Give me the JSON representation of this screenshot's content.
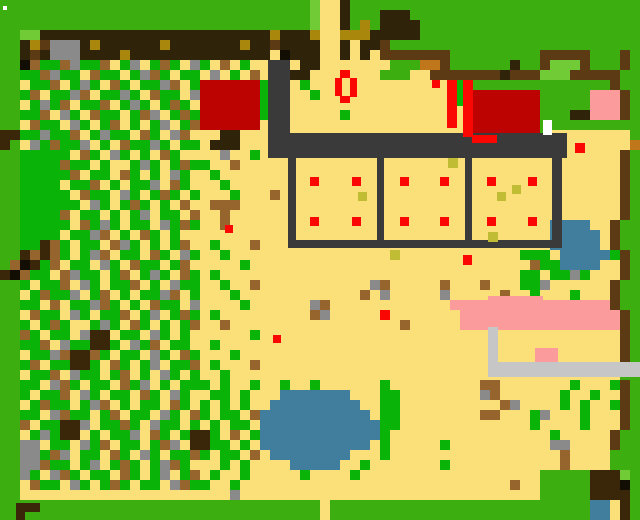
{
  "map": {
    "kind": "pixel-tile-world-map",
    "cols": 64,
    "rows": 52,
    "tile_size": 10,
    "palette": {
      "G": "#3CAE10",
      "V": "#0AB307",
      "L": "#70CB36",
      "Y": "#FBDF79",
      "B": "#2F2409",
      "F": "#5C3A13",
      "b": "#95652D",
      "N": "#3A2709",
      "O": "#C0771C",
      "A": "#A9860C",
      "k": "#C0BD35",
      "K": "#3A3A3A",
      "S": "#8A8A8A",
      "s": "#C6C6C6",
      "R": "#BC0302",
      "r": "#FB0703",
      "P": "#FB9B9B",
      "W": "#417E9E",
      "w": "#FFFFFF",
      "E": "#120E04"
    },
    "palette_legend": {
      "G": "grass-border-green",
      "V": "vegetation-green",
      "L": "light-green",
      "Y": "sand-yellow",
      "B": "dark-band-brown",
      "F": "fence-brown",
      "b": "dirt-brown",
      "N": "dark-blob-brown",
      "O": "copper-orange",
      "A": "gold-accent",
      "k": "khaki-sprout",
      "K": "compound-dark-gray",
      "S": "stone-gray",
      "s": "road-light-gray",
      "R": "building-dark-red",
      "r": "bright-red",
      "P": "pink",
      "W": "water-blue",
      "w": "white",
      "E": "near-black"
    },
    "grid": [
      "GGGGGGGGGGGGGGGGGGGGGGGGGGGGGGGLYYBGGGGGGGGGGGGGGGGGGGGGGGGGGGG",
      "GGGGGGGGGGGGGGGGGGGGGGGGGGGGGGGLYYBGGGBBBGGGGGGGGGGGGGGGGGGGGGG",
      "GGGGGGGGGGGGGGGGGGGGGGGGGGGGGGGLYYBGAGBBBBGGGGGGGGGGGGGGGGGGGGG",
      "GGLLBBBBBBBBBBBBBBBBBBBBBBBABBBAYYAAABBBBBGGGGGGGGGGGGGGGGGGGGGG",
      "GGBAFSSSBABBBBBBABBBBBBBABBFBBBBYYBYBBFGGGGGGGGGGGGGGGGGGGGGGGGG",
      "GGBFBSSSBBBBABBBBBBBBBBBBBBYEBBBYYBYBYFFFFFFFGGGGGGGGGFFFFFGGGFG",
      "GGEbVVbSVVbYVSYVbVYSVYbYVYYYYYBBYYYYYYYGGGOOFGGGGGGBGGFLLLFGGGFG",
      "GGVVbSVVYbVVYVSbVYVVYSYVYbYYYBBYYYYYYYGGGYYFFFFFFFBFFFLLLFFFFFG",
      "GGYVVbYVSVYbVYVVSbYVRRRRRRVYYYVYYYYYYYYYYYYYYYGGGGGGGGGGGGGGGFG",
      "GGVbYVVSbYVVSVYbVVYSRRRRRRVYYYYVYYYYYYYYYYYYYYYRRRRRRRGGGGGPPPFG",
      "GGYVSVbYVVbYVSVYVbVYRRRRRRVYYYYYYYYYYYYYYYYYYYYRRRRRRRGGGGGPPPFG",
      "GGVVbYSVYbVVYVbSYVbVRRRRRRVYYYYYYYVYYYYYYYYYYYYRRRRRRRGGGBBPPPFG",
      "GGYbVVYSVYVbYVYVSYVbRRRRRRYYYYYYYYYYYYYYYYYYYYYRRRRRRRGGGGGGGGGG",
      "NNVVSVVbYVSVVYbVYSbYYYBBYYYYYYYYYYYYYYYYYYYYYYYRRRRRRRGYYYYYYYYG",
      "NGYSVbVVSYVYbVVSVYVVYBBBYYYYYYYYYYYYYYYYYYYYYYYYYYYYYYYYYYYYYYYO",
      "GGVVVVVYbVYSVYVYbVYYYYSYYVYYYYYYYYYYYYYYYYYYYYYYYYYYYYYYYYYYYYFG",
      "GGVVVVbVVYVYYVSVYVbVVYYbYYYYYYYYYYYYYYYYYYYYYYYYYYYYYYYYYYYYYYFG",
      "GGVVVVVbYVVYbVYVYSVYYVYYYYYYYYYYYYYYYYYYYYYYYYYYYYYYYYYYYYYYYYFG",
      "GGVVVVYVVbYVYVVSYbVYYYVYYYYYYYYYYYYYYYYYYYYYYYYYYYYYYYYYYYYYYYFG",
      "GGVVVVVYbVVYSVYVbVYVYYYVYYYbYYYYYYYYYYYYYYYYYYYYYYYYYYYYYYYYYYFG",
      "GGVVVVVVYSVYVbVYVYbYYbbbYYYYYYYYYYYYYYYYYYYYYYYYYYYYYYYYYYYYYYFG",
      "GGVVVVbYVVYVYVSYVVYbYYbYYYYYYYYYYYYYYYYYYYYYYYYYYYYYYYYYYYYYYYFG",
      "GGVVVVVYbVSVYVVYSVbVYYbYYYYYYYYYYYYYYYYYYYYYYYYYYYYYYYYWWWWYYFG",
      "GGVVVVYVVSbYVYbVYVYYYYYYYYYYYYYYYYYYYYYYYYYYYYYYYYYYYYYWWWWWYFG",
      "GGVVNbVYVVYbSVYVYVbYYVYYYbYYYYYYYYYYYYYYYYYYYYYYYYYYYYYWWWWWYFG",
      "GGNbNbVYVSbYVVYbVYSVYYVYYYYYYYYYYYYYYYYkYYYYYYYYYYYYVVVYWWWWWVFG",
      "GbENVbYVVYSVYbVVYVbYYYYYVYYYYYYYYYYYYYYYYYYYYYYYYYYYYbVVWWWWYYFG",
      "NEbVVYbSVVYVbYVSVYbVYVYYYYYYYYYYYYYYYYYYYYYYYYYYYYYYVVYVVSVYYYFG",
      "GGVYVVbYSVYVVbYVYSVVYYVYYbYYYYYYYYYYYSbYYYYYbYYYbYYYVVSYYYYYYFG",
      "GGYVbVVSYVbYVYVVSbYVYYYVYYYYYYYYYYYYbYSYYYYYSYYYYYbYYVYYYVYYYFG",
      "GGVVYbYVVSbVYVYbVVYSYYYYVYYYYYYSbYYYYYYYYYYYYPPPPPPPPPPPPPPPPFG",
      "GGYbVVYSVYVVbYVSYVbVYVYYYYYYYYYbSYYYYYrYYYYYYYPPPPPPPPPPPPPPPPFG",
      "GGVYVbVYYVSVYbVYVYVbYYbYYYYYYYYYYYYYYYYYbYYYYYPPPPPPPPPPPPPPPPFG",
      "GGbVYVVYSNNYVVYSVYVYYYYYYVYYYYYYYYYYYYYYYYYYYYYYYYYYYYYYYYYYYYFG",
      "GGVVbYSVVNNVYSVbYVVYYVYYYYYYYYYYYYYYYYYYYYYYYYYYYYYYYYYYYYYYYYFG",
      "GGYVVSbNNbVYVVYSVYbVYYYVYYYYYYYYYYYYYYYYYYYYYYYYYYYYYYYYYYYYYYFG",
      "GGVbYVVNNVYbVYVSYVVbYVYYYbYYYYYYYYYYYYYYYYYYYYYYYYYYYYYYYYYYYYFG",
      "GGYVVbYSVVYVbYVYSVYVYYVYYYYYYYYYYYYYYYYYYYYYYYYYYYYYYYYYYYYYYYGG",
      "GGVVYSbVYVVYbVSYVYVVVYVYYVYYVYYVYYYYYYVYYYYYYYYYbbYYYYYYYVYYYVFG",
      "GGVYVVbYSVYVVYbVYSVYYVVYVYYYWWWWWWWYYYVVYYYYYYYYSbYYYYYYVYYVYYFG",
      "GGYVbVVYVSbYVYVVYbVYVYVYVYYWWWWWWWWWYYVVYYYYYYYYYYbSYYYYVYVYYVFG",
      "GGVVYSbVVYVbYVVYSVYbVYVVYbWWWWWWWWWWWYVVYYYYYYYYbbYYYVSYYYVYYYFG",
      "GGbYVVNNSYVVbVYSVVYVYVYVVYWWWWWWWWWWWWVVYYYYYYYYYYYYYVYYYYVYYYFG",
      "GGYVSVNNYVYVVSYbVYVNNVYbYVWWWWWWWWWWWWVYYYYYYYYYYYYYYYYVYYYYYFG",
      "GGSSYVVYSVbYVVYVbSYNNVVYVYWWWWWWWWWWWYVYYYYYVYYYYYYYYYYSSYYYYFG",
      "GGSSVbSYVVYbVYSVYVVbVYVVYbYWWWWWWWWYYYVYYYYYYYYYYYYYYYYYbYYYYGG",
      "GGSSbVVYVSYVbVYVSbVYYYVYVYYYYWWWWWYYVYYYYYYYVYYYYYYYYYYYbYYYYGG",
      "GGSVYSbVYVVYbVYVSYVbYVYYVYYYYYVYYYYVYYYYYYYYYYYYYYYYYYGGGGGNNNL",
      "GGYbVVYSVYVbVYVVYSbVVYYVYYYYYYYYYYYYYYYYYYYYYYYYYYYbYYGGGGGNNNE",
      "GGYYYYYYYYYYYYYYYYYYYYYSYYYYYYYYYYYYYYYYYYYYYYYYYYYYYYGGGGGNNNN",
      "GGGGGGGGGGGGGGGGGGGGGGGGGGGGGGGGYGGGGGGGGGGGGGGGGGGGGGGGGGGWWYN",
      "GGGGGGGGGGGGGGGGGGGGGGGGGGGGGGGGYGGGGGGGGGGGGGGGGGGGGGGGGGGWWYN"
    ],
    "overlays": [
      {
        "name": "white-speck",
        "x": 3,
        "y": 6,
        "w": 4,
        "h": 4,
        "c": "w"
      },
      {
        "name": "dark-path-vertical",
        "x": 268,
        "y": 60,
        "w": 22,
        "h": 75,
        "c": "K"
      },
      {
        "name": "compound-top-wall",
        "x": 268,
        "y": 133,
        "w": 299,
        "h": 25,
        "c": "K"
      },
      {
        "name": "compound-right-wall",
        "x": 552,
        "y": 135,
        "w": 10,
        "h": 113,
        "c": "K"
      },
      {
        "name": "compound-bottom-wall",
        "x": 288,
        "y": 240,
        "w": 270,
        "h": 8,
        "c": "K"
      },
      {
        "name": "pen-divider-1",
        "x": 288,
        "y": 158,
        "w": 8,
        "h": 90,
        "c": "K"
      },
      {
        "name": "pen-divider-2",
        "x": 377,
        "y": 158,
        "w": 7,
        "h": 90,
        "c": "K"
      },
      {
        "name": "pen-divider-3",
        "x": 465,
        "y": 158,
        "w": 7,
        "h": 90,
        "c": "K"
      },
      {
        "name": "red-crop-dot",
        "x": 310,
        "y": 177,
        "w": 9,
        "h": 9,
        "c": "r"
      },
      {
        "name": "red-crop-dot",
        "x": 352,
        "y": 177,
        "w": 9,
        "h": 9,
        "c": "r"
      },
      {
        "name": "red-crop-dot",
        "x": 310,
        "y": 217,
        "w": 9,
        "h": 9,
        "c": "r"
      },
      {
        "name": "red-crop-dot",
        "x": 352,
        "y": 217,
        "w": 9,
        "h": 9,
        "c": "r"
      },
      {
        "name": "red-crop-dot",
        "x": 400,
        "y": 177,
        "w": 9,
        "h": 9,
        "c": "r"
      },
      {
        "name": "red-crop-dot",
        "x": 440,
        "y": 177,
        "w": 9,
        "h": 9,
        "c": "r"
      },
      {
        "name": "red-crop-dot",
        "x": 400,
        "y": 217,
        "w": 9,
        "h": 9,
        "c": "r"
      },
      {
        "name": "red-crop-dot",
        "x": 440,
        "y": 217,
        "w": 9,
        "h": 9,
        "c": "r"
      },
      {
        "name": "red-crop-dot",
        "x": 487,
        "y": 177,
        "w": 9,
        "h": 9,
        "c": "r"
      },
      {
        "name": "red-crop-dot",
        "x": 528,
        "y": 177,
        "w": 9,
        "h": 9,
        "c": "r"
      },
      {
        "name": "red-crop-dot",
        "x": 487,
        "y": 217,
        "w": 9,
        "h": 9,
        "c": "r"
      },
      {
        "name": "red-crop-dot",
        "x": 528,
        "y": 217,
        "w": 9,
        "h": 9,
        "c": "r"
      },
      {
        "name": "sprout-tile",
        "x": 358,
        "y": 192,
        "w": 9,
        "h": 9,
        "c": "k"
      },
      {
        "name": "sprout-tile",
        "x": 448,
        "y": 158,
        "w": 10,
        "h": 10,
        "c": "k"
      },
      {
        "name": "sprout-tile",
        "x": 497,
        "y": 192,
        "w": 9,
        "h": 9,
        "c": "k"
      },
      {
        "name": "sprout-tile",
        "x": 512,
        "y": 185,
        "w": 9,
        "h": 9,
        "c": "k"
      },
      {
        "name": "sprout-tile",
        "x": 488,
        "y": 232,
        "w": 10,
        "h": 10,
        "c": "k"
      },
      {
        "name": "red-ring-top",
        "x": 340,
        "y": 70,
        "w": 10,
        "h": 8,
        "c": "r"
      },
      {
        "name": "red-ring-left",
        "x": 335,
        "y": 78,
        "w": 7,
        "h": 18,
        "c": "r"
      },
      {
        "name": "red-ring-right",
        "x": 350,
        "y": 78,
        "w": 7,
        "h": 19,
        "c": "r"
      },
      {
        "name": "red-ring-bottom",
        "x": 340,
        "y": 96,
        "w": 10,
        "h": 7,
        "c": "r"
      },
      {
        "name": "red-banner-1",
        "x": 447,
        "y": 80,
        "w": 10,
        "h": 48,
        "c": "r"
      },
      {
        "name": "red-banner-2",
        "x": 463,
        "y": 80,
        "w": 10,
        "h": 57,
        "c": "r"
      },
      {
        "name": "banner-gap-green",
        "x": 457,
        "y": 80,
        "w": 6,
        "h": 26,
        "c": "V"
      },
      {
        "name": "barn-door-red",
        "x": 472,
        "y": 135,
        "w": 25,
        "h": 8,
        "c": "r"
      },
      {
        "name": "white-door-tile",
        "x": 543,
        "y": 120,
        "w": 9,
        "h": 15,
        "c": "w"
      },
      {
        "name": "red-marker-1",
        "x": 432,
        "y": 80,
        "w": 8,
        "h": 8,
        "c": "r"
      },
      {
        "name": "red-marker-2",
        "x": 463,
        "y": 255,
        "w": 9,
        "h": 10,
        "c": "r"
      },
      {
        "name": "red-marker-3",
        "x": 575,
        "y": 143,
        "w": 10,
        "h": 10,
        "c": "r"
      },
      {
        "name": "red-marker-4",
        "x": 273,
        "y": 335,
        "w": 8,
        "h": 8,
        "c": "r"
      },
      {
        "name": "red-marker-5",
        "x": 225,
        "y": 225,
        "w": 8,
        "h": 8,
        "c": "r"
      },
      {
        "name": "pink-ledge-upper",
        "x": 488,
        "y": 296,
        "w": 55,
        "h": 8,
        "c": "P"
      },
      {
        "name": "pink-ledge-small",
        "x": 535,
        "y": 348,
        "w": 23,
        "h": 20,
        "c": "P"
      },
      {
        "name": "gray-pillar",
        "x": 488,
        "y": 327,
        "w": 10,
        "h": 40,
        "c": "s"
      },
      {
        "name": "gray-road",
        "x": 488,
        "y": 362,
        "w": 152,
        "h": 15,
        "c": "s"
      },
      {
        "name": "bottom-left-fence-h",
        "x": 16,
        "y": 503,
        "w": 24,
        "h": 9,
        "c": "N"
      },
      {
        "name": "bottom-left-fence-v",
        "x": 16,
        "y": 503,
        "w": 9,
        "h": 17,
        "c": "N"
      }
    ]
  }
}
